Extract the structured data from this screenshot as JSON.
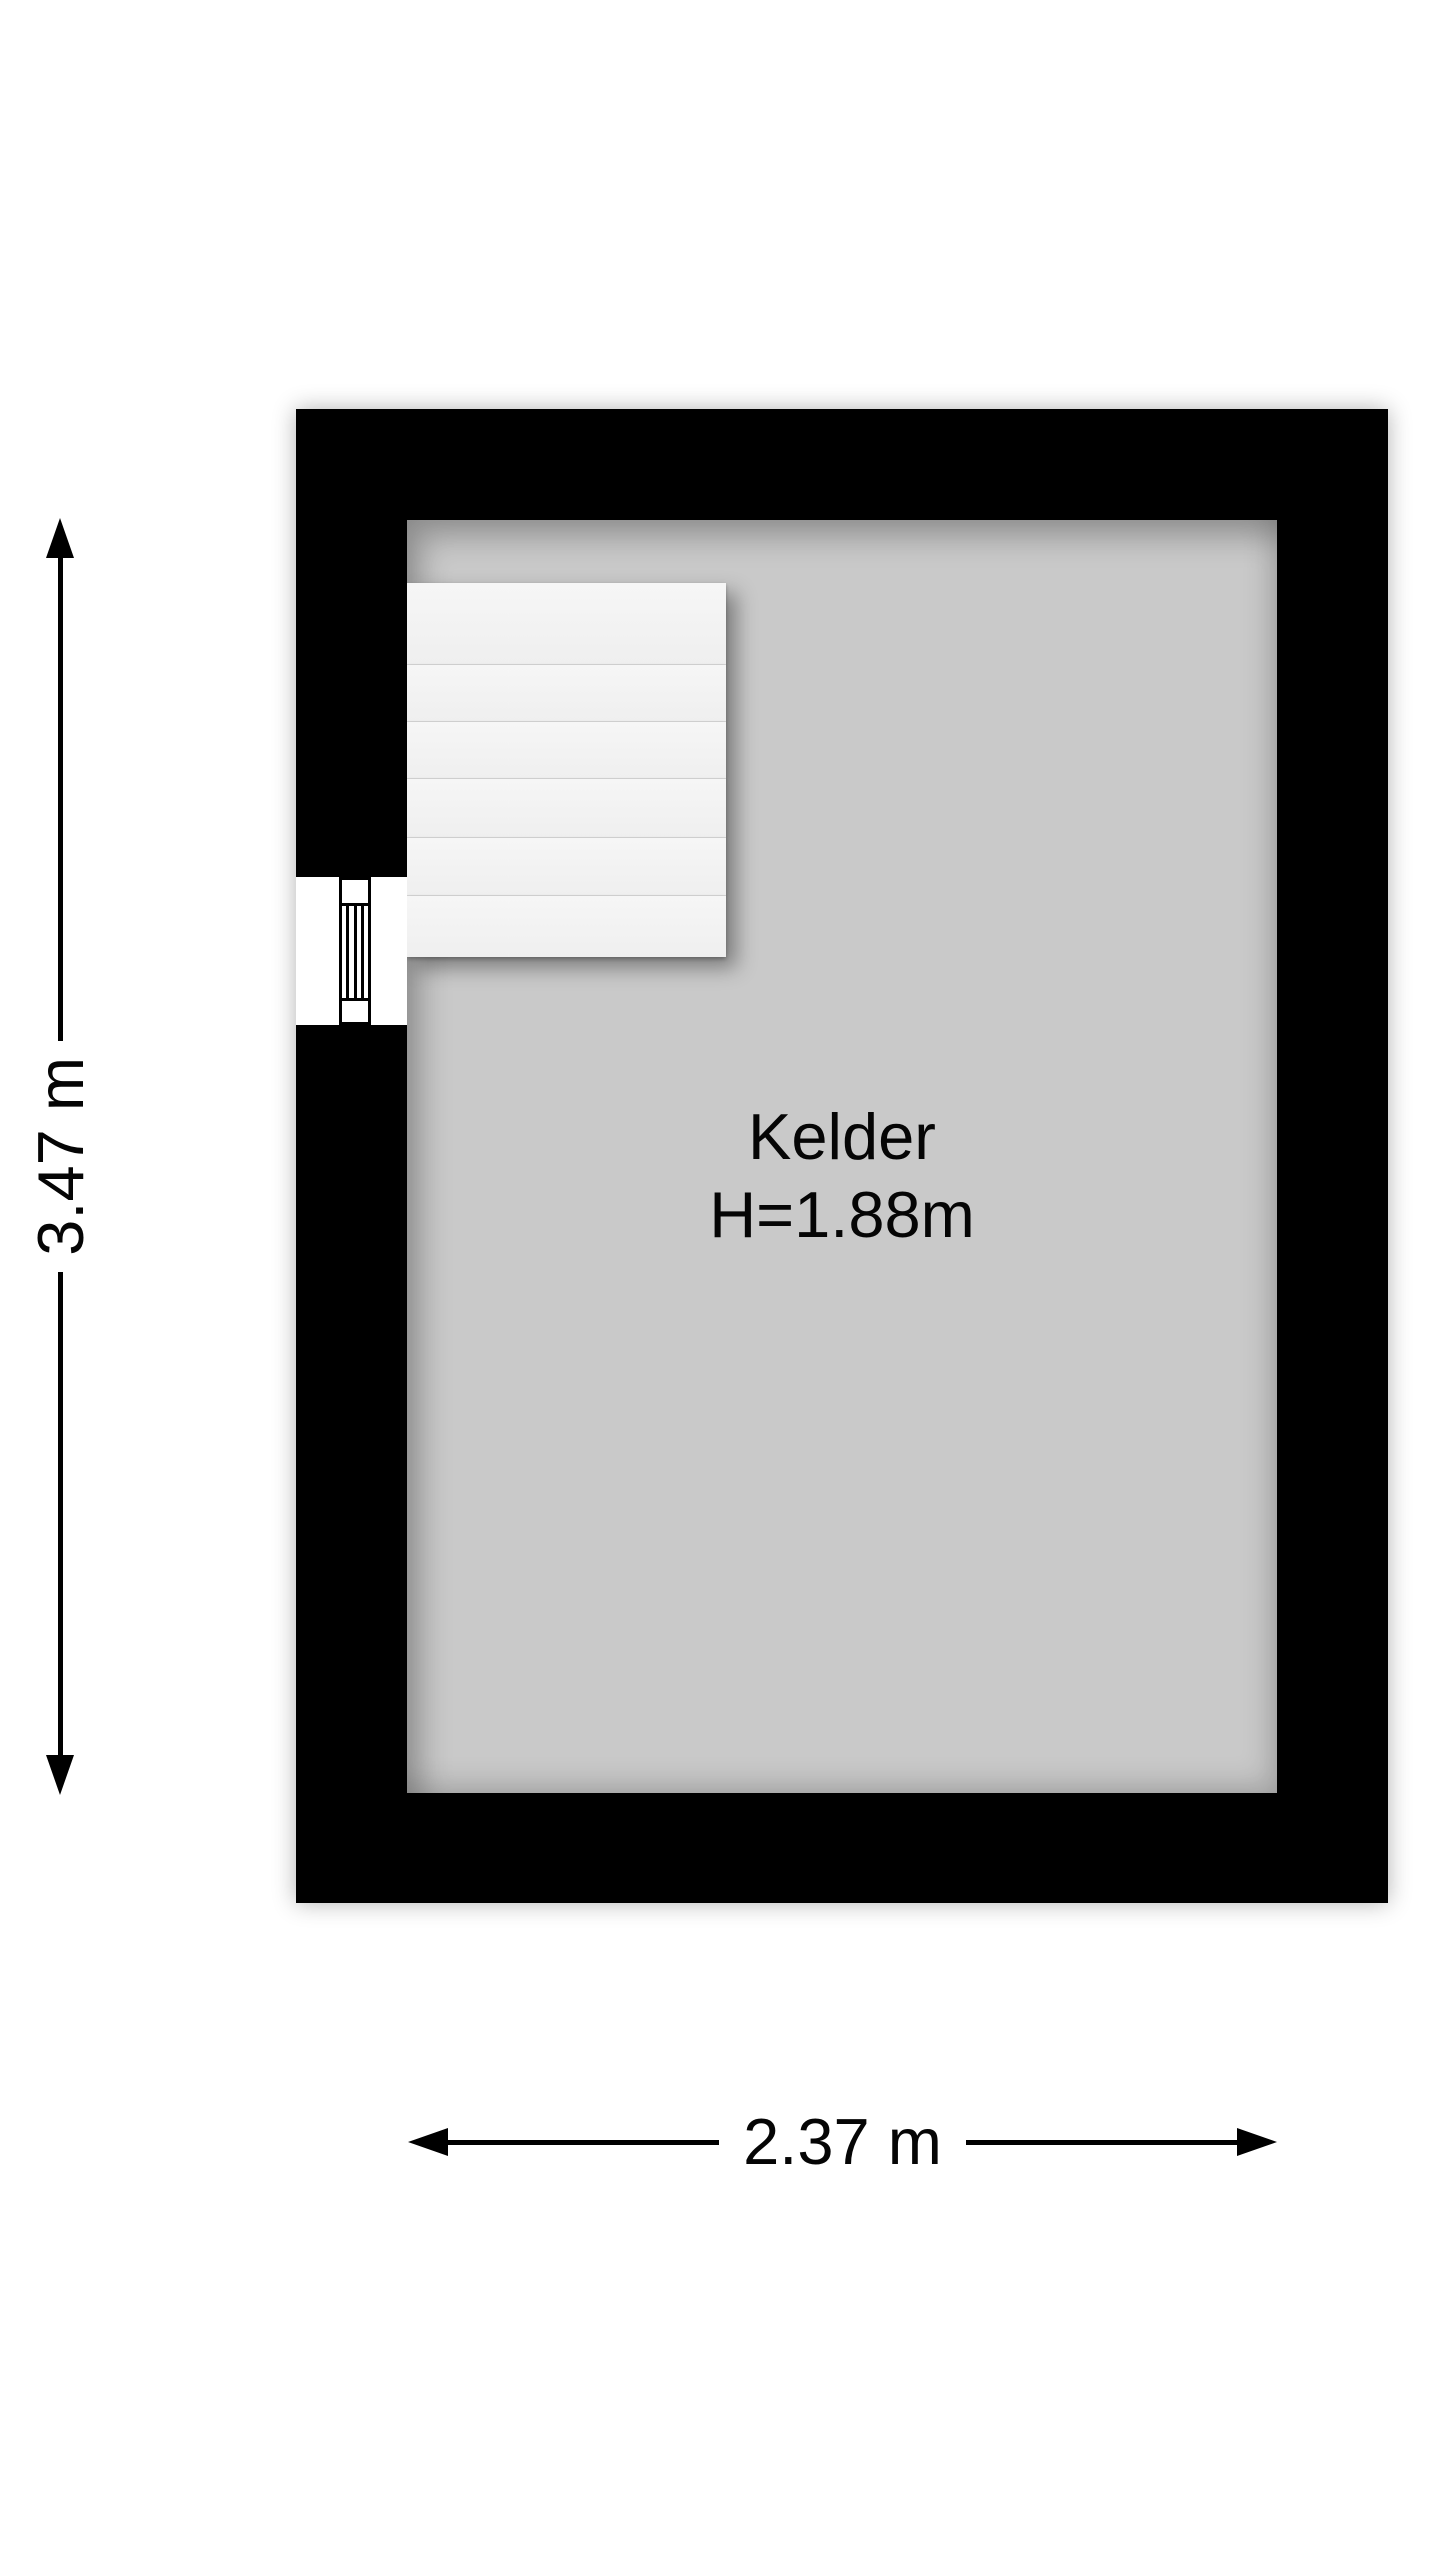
{
  "floorplan": {
    "room": {
      "name": "Kelder",
      "height_label": "H=1.88m"
    },
    "dimensions": {
      "vertical_label": "3.47 m",
      "horizontal_label": "2.37 m"
    },
    "stairs": {
      "tread_count": 6,
      "location": "top-left"
    },
    "window": {
      "location": "left-wall"
    },
    "colors": {
      "wall": "#000000",
      "floor": "#c9c9c9",
      "stairs": "#f4f4f4",
      "background": "#ffffff",
      "dimension_lines": "#000000",
      "text": "#050505"
    }
  }
}
